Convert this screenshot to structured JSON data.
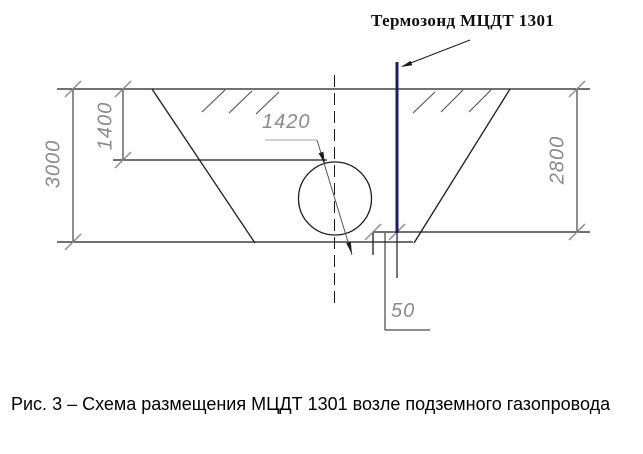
{
  "probe_label": "Термозонд МЦДТ 1301",
  "caption": "Рис. 3 – Схема размещения МЦДТ 1301 возле подземного газопровода",
  "dimensions": {
    "trench_depth_left": "3000",
    "pipe_top_depth": "1400",
    "pipe_diameter": "1420",
    "trench_depth_right": "2800",
    "probe_to_pipe_offset": "50"
  },
  "colors": {
    "probe": "#1a1a75",
    "drawing_line": "#1c1c1c",
    "dimension_gray": "#8c8c8c",
    "leader_gray": "#b5b5b5",
    "diameter_line": "#555555",
    "hatch": "#4a4a4a"
  }
}
